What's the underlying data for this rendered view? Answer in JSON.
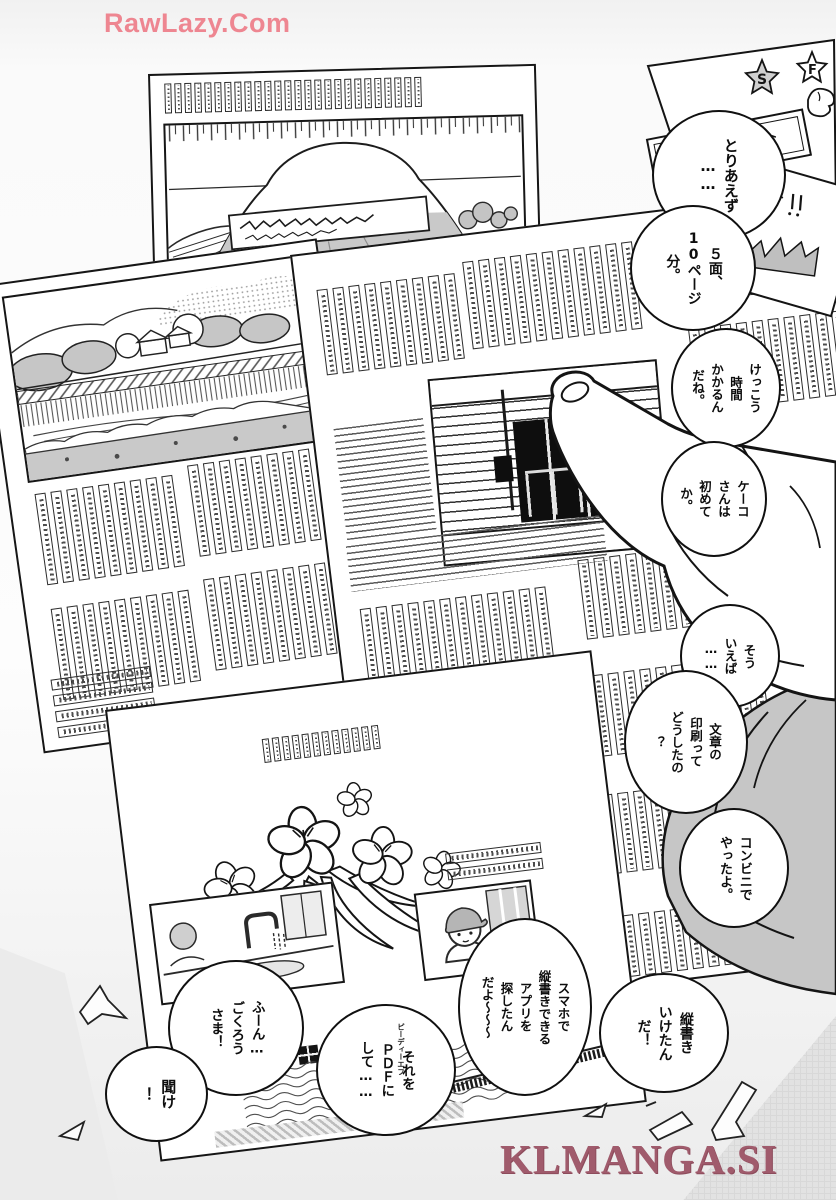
{
  "watermarks": {
    "top_left": "RawLazy.Com",
    "bottom_right": "KLMANGA.SI"
  },
  "colors": {
    "watermark_pink": "#ee8691",
    "watermark_rose": "#a05b6c",
    "ink": "#1a1a1a",
    "tone_gray": "#c9c9c9"
  },
  "speech_bubbles": [
    {
      "id": "toriaezu",
      "text": "とりあえず\n……"
    },
    {
      "id": "pages",
      "text": "５面、\n10ページ\n分。"
    },
    {
      "id": "kekkou",
      "text": "けっこう\n時間\nかかるん\nだね。"
    },
    {
      "id": "keeko",
      "text": "ケーコ\nさんは\n初めて\nか。"
    },
    {
      "id": "souieba",
      "text": "そう\nいえば\n……"
    },
    {
      "id": "insatsu",
      "text": "文章の\n印刷って\nどうしたの\n？"
    },
    {
      "id": "konbini",
      "text": "コンビニで\nやったよ。"
    },
    {
      "id": "tategaki",
      "text": "縦書き\nいけたん\nだ！"
    },
    {
      "id": "sumaho",
      "text": "スマホで\n縦書きできる\nアプリを\n探したん\nだよ～～～"
    },
    {
      "id": "pdf",
      "text": "それを\nＰＤＦに\nして……",
      "furigana": "ピーディーエフ"
    },
    {
      "id": "fuun",
      "text": "ふーん…\nごくろう\nさま！"
    },
    {
      "id": "kike",
      "text": "聞け\n！"
    }
  ],
  "decorations": {
    "star_left": "S",
    "star_right": "F"
  }
}
